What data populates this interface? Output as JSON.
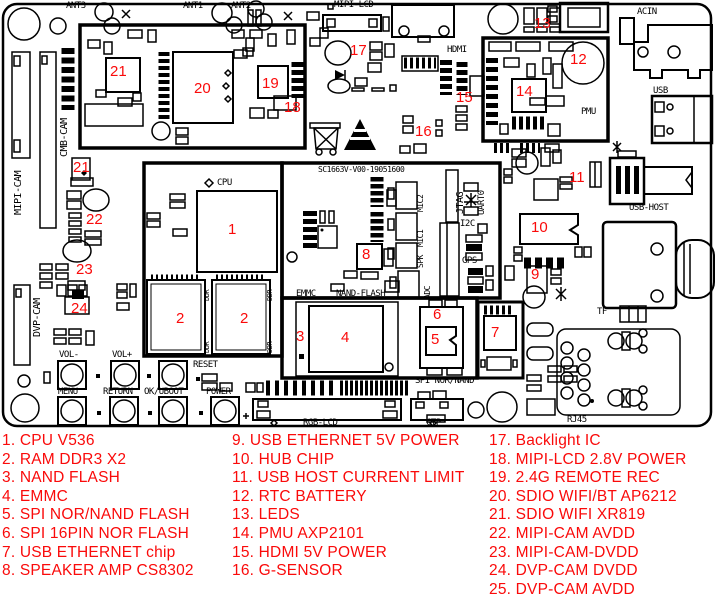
{
  "colors": {
    "label_red": "#fa0a0a",
    "silk_black": "#000000",
    "board_bg": "#ffffff"
  },
  "board": {
    "code": "SC1663V-V00-19051600",
    "silk_labels": [
      {
        "id": "ant3",
        "text": "ANT3",
        "x": 66,
        "y": 2
      },
      {
        "id": "ant1",
        "text": "ANT1",
        "x": 183,
        "y": 2
      },
      {
        "id": "ant2",
        "text": "ANT2",
        "x": 231,
        "y": 2
      },
      {
        "id": "mipi-lcd",
        "text": "MIPI-LCD",
        "x": 334,
        "y": 1
      },
      {
        "id": "hdmi",
        "text": "HDMI",
        "x": 447,
        "y": 46
      },
      {
        "id": "acin",
        "text": "ACIN",
        "x": 637,
        "y": 8
      },
      {
        "id": "usb",
        "text": "USB",
        "x": 653,
        "y": 87
      },
      {
        "id": "pmu",
        "text": "PMU",
        "x": 581,
        "y": 108
      },
      {
        "id": "usb-host",
        "text": "USB-HOST",
        "x": 629,
        "y": 204
      },
      {
        "id": "cpu",
        "text": "CPU",
        "x": 217,
        "y": 179
      },
      {
        "id": "board-code",
        "text": "SC1663V-V00-19051600",
        "x": 318,
        "y": 166,
        "size": 8
      },
      {
        "id": "emmc",
        "text": "EMMC",
        "x": 296,
        "y": 290
      },
      {
        "id": "nand-flash",
        "text": "NAND-FLASH",
        "x": 336,
        "y": 290
      },
      {
        "id": "spi-nor-nand",
        "text": "SPI NOR/NAND",
        "x": 415,
        "y": 377
      },
      {
        "id": "i2c",
        "text": "I2C",
        "x": 460,
        "y": 220
      },
      {
        "id": "gps",
        "text": "GPS",
        "x": 462,
        "y": 257
      },
      {
        "id": "tf",
        "text": "TF",
        "x": 597,
        "y": 308
      },
      {
        "id": "rj45",
        "text": "RJ45",
        "x": 567,
        "y": 416
      },
      {
        "id": "rgb-lcd",
        "text": "RGB-LCD",
        "x": 303,
        "y": 419
      },
      {
        "id": "ctp",
        "text": "CTP",
        "x": 426,
        "y": 419
      },
      {
        "id": "reset",
        "text": "RESET",
        "x": 193,
        "y": 361
      },
      {
        "id": "vol-minus",
        "text": "VOL-",
        "x": 59,
        "y": 351
      },
      {
        "id": "vol-plus",
        "text": "VOL+",
        "x": 112,
        "y": 351
      },
      {
        "id": "menu",
        "text": "MENU",
        "x": 58,
        "y": 388
      },
      {
        "id": "return",
        "text": "RETURN",
        "x": 103,
        "y": 388
      },
      {
        "id": "ok-uboot",
        "text": "OK/UBOOT",
        "x": 144,
        "y": 388
      },
      {
        "id": "power",
        "text": "POWER",
        "x": 206,
        "y": 388
      }
    ],
    "vertical_labels": [
      {
        "id": "mipi-cam",
        "text": "MIPI-CAM",
        "x": 14,
        "y": 215,
        "size": 10
      },
      {
        "id": "cmb-cam",
        "text": "CMB-CAM",
        "x": 60,
        "y": 157,
        "size": 10
      },
      {
        "id": "dvp-cam",
        "text": "DVP-CAM",
        "x": 33,
        "y": 337,
        "size": 10
      },
      {
        "id": "mic2",
        "text": "MIC2",
        "x": 417,
        "y": 212,
        "size": 8
      },
      {
        "id": "mic1",
        "text": "MIC1",
        "x": 417,
        "y": 247,
        "size": 8
      },
      {
        "id": "spk",
        "text": "SPK",
        "x": 417,
        "y": 268,
        "size": 8
      },
      {
        "id": "adc",
        "text": "ADC",
        "x": 424,
        "y": 299,
        "size": 8
      },
      {
        "id": "jtag",
        "text": "JTAG",
        "x": 456,
        "y": 214,
        "size": 10
      },
      {
        "id": "uart0",
        "text": "UART0",
        "x": 478,
        "y": 215,
        "size": 9
      },
      {
        "id": "ddr-1",
        "text": "DDR",
        "x": 204,
        "y": 301,
        "size": 7
      },
      {
        "id": "ddr-2",
        "text": "DDR",
        "x": 204,
        "y": 353,
        "size": 7
      },
      {
        "id": "ddr-3",
        "text": "DDR",
        "x": 267,
        "y": 301,
        "size": 7
      },
      {
        "id": "ddr-4",
        "text": "DDR",
        "x": 267,
        "y": 353,
        "size": 7
      }
    ],
    "numbers": [
      {
        "n": "1",
        "x": 228,
        "y": 222
      },
      {
        "n": "2",
        "x": 176,
        "y": 311
      },
      {
        "n": "2",
        "x": 240,
        "y": 311
      },
      {
        "n": "3",
        "x": 296,
        "y": 329
      },
      {
        "n": "4",
        "x": 341,
        "y": 330
      },
      {
        "n": "5",
        "x": 431,
        "y": 332
      },
      {
        "n": "6",
        "x": 433,
        "y": 307
      },
      {
        "n": "7",
        "x": 491,
        "y": 325
      },
      {
        "n": "8",
        "x": 362,
        "y": 247
      },
      {
        "n": "9",
        "x": 531,
        "y": 267
      },
      {
        "n": "10",
        "x": 531,
        "y": 220
      },
      {
        "n": "11",
        "x": 569,
        "y": 170
      },
      {
        "n": "12",
        "x": 570,
        "y": 52
      },
      {
        "n": "13",
        "x": 534,
        "y": 16
      },
      {
        "n": "14",
        "x": 516,
        "y": 84
      },
      {
        "n": "15",
        "x": 456,
        "y": 90
      },
      {
        "n": "16",
        "x": 415,
        "y": 124
      },
      {
        "n": "17",
        "x": 350,
        "y": 43
      },
      {
        "n": "18",
        "x": 284,
        "y": 100
      },
      {
        "n": "19",
        "x": 262,
        "y": 76
      },
      {
        "n": "20",
        "x": 194,
        "y": 81
      },
      {
        "n": "21",
        "x": 110,
        "y": 64
      },
      {
        "n": "21",
        "x": 73,
        "y": 160
      },
      {
        "n": "22",
        "x": 86,
        "y": 212
      },
      {
        "n": "23",
        "x": 76,
        "y": 262
      },
      {
        "n": "24",
        "x": 71,
        "y": 301
      }
    ]
  },
  "legend": {
    "column_x": [
      2,
      232,
      489
    ],
    "top": 432,
    "line_height": 18.6,
    "columns": [
      {
        "items": [
          "1. CPU V536",
          "2. RAM DDR3 X2",
          "3. NAND FLASH",
          "4. EMMC",
          "5. SPI NOR/NAND FLASH",
          "6. SPI 16PIN NOR FLASH",
          "7. USB ETHERNET chip",
          "8. SPEAKER AMP CS8302"
        ]
      },
      {
        "items": [
          "9. USB ETHERNET 5V POWER",
          "10. HUB CHIP",
          "11. USB HOST CURRENT LIMIT",
          "12. RTC BATTERY",
          "13. LEDS",
          "14. PMU AXP2101",
          "15. HDMI 5V POWER",
          "16. G-SENSOR"
        ]
      },
      {
        "items": [
          "17. Backlight IC",
          "18. MIPI-LCD 2.8V POWER",
          "19. 2.4G REMOTE REC",
          "20. SDIO WIFI/BT AP6212",
          "21. SDIO WIFI XR819",
          "22. MIPI-CAM AVDD",
          "23. MIPI-CAM-DVDD",
          "24. DVP-CAM DVDD",
          "25. DVP-CAM AVDD"
        ]
      }
    ]
  }
}
